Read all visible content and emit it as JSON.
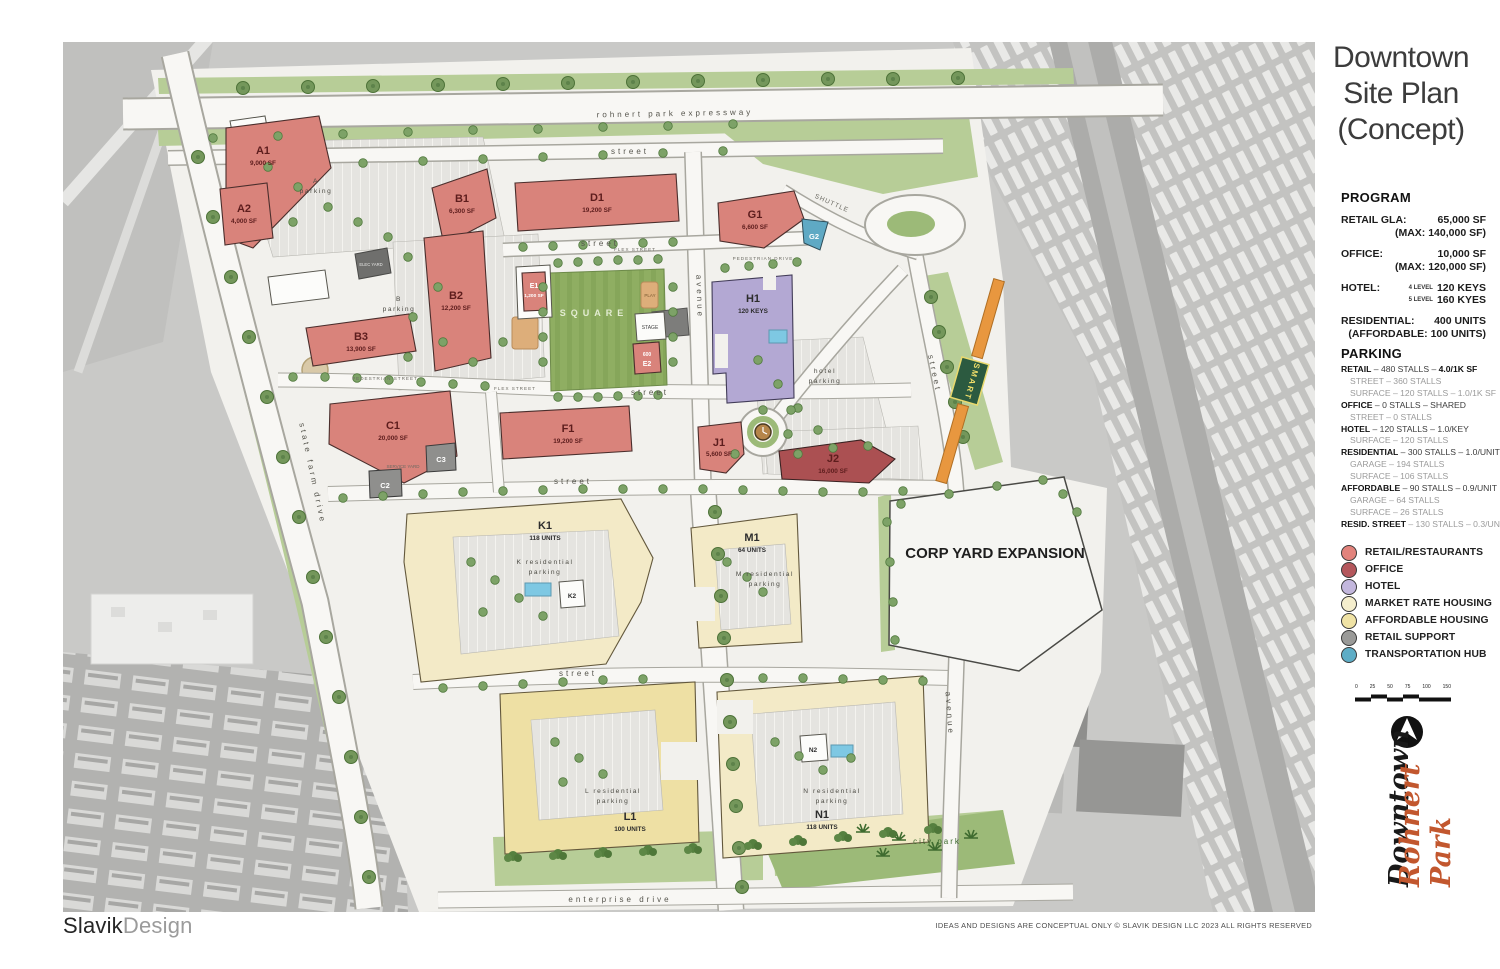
{
  "title": {
    "line1": "Downtown",
    "line2": "Site Plan",
    "line3": "(Concept)"
  },
  "program": {
    "heading": "PROGRAM",
    "retail": {
      "label": "RETAIL GLA:",
      "value": "65,000 SF",
      "sub": "(MAX: 140,000 SF)"
    },
    "office": {
      "label": "OFFICE:",
      "value": "10,000 SF",
      "sub": "(MAX: 120,000 SF)"
    },
    "hotel": {
      "label": "HOTEL:",
      "l1small": "4 LEVEL",
      "l1": "120 KEYS",
      "l2small": "5 LEVEL",
      "l2": "160 KYES"
    },
    "residential": {
      "label": "RESIDENTIAL:",
      "value": "400 UNITS",
      "sub": "(AFFORDABLE: 100 UNITS)"
    }
  },
  "parking": {
    "heading": "PARKING",
    "lines": [
      {
        "lead": "RETAIL",
        "rest": " – 480 STALLS – ",
        "tail": "4.0/1K SF"
      },
      {
        "lead": "",
        "rest": "STREET – 360 STALLS",
        "tail": ""
      },
      {
        "lead": "",
        "rest": "SURFACE – 120 STALLS – 1.0/1K SF",
        "tail": ""
      },
      {
        "lead": "OFFICE",
        "rest": " – 0 STALLS – SHARED",
        "tail": ""
      },
      {
        "lead": "",
        "rest": "STREET – 0 STALLS",
        "tail": ""
      },
      {
        "lead": "HOTEL",
        "rest": " – 120 STALLS – 1.0/KEY",
        "tail": ""
      },
      {
        "lead": "",
        "rest": "SURFACE – 120 STALLS",
        "tail": ""
      },
      {
        "lead": "RESIDENTIAL",
        "rest": " – 300 STALLS – 1.0/UNIT",
        "tail": ""
      },
      {
        "lead": "",
        "rest": "GARAGE – 194 STALLS",
        "tail": ""
      },
      {
        "lead": "",
        "rest": "SURFACE – 106 STALLS",
        "tail": ""
      },
      {
        "lead": "AFFORDABLE",
        "rest": " – 90 STALLS – 0.9/UNIT",
        "tail": ""
      },
      {
        "lead": "",
        "rest": "GARAGE – 64 STALLS",
        "tail": ""
      },
      {
        "lead": "",
        "rest": "SURFACE – 26 STALLS",
        "tail": ""
      },
      {
        "lead": "RESID. STREET",
        "rest": " – 130 STALLS –  0.3/UNIT",
        "tail": ""
      }
    ]
  },
  "legend": {
    "items": [
      {
        "label": "RETAIL/RESTAURANTS",
        "color": "#e2837c"
      },
      {
        "label": "OFFICE",
        "color": "#b4575c"
      },
      {
        "label": "HOTEL",
        "color": "#c3b7dd"
      },
      {
        "label": "MARKET RATE HOUSING",
        "color": "#f5eecd"
      },
      {
        "label": "AFFORDABLE HOUSING",
        "color": "#f0e3a5"
      },
      {
        "label": "RETAIL SUPPORT",
        "color": "#9a9a98"
      },
      {
        "label": "TRANSPORTATION HUB",
        "color": "#5eadc6"
      }
    ]
  },
  "scalebar": {
    "ticks": [
      "0",
      "25",
      "50",
      "75",
      "100",
      "150"
    ]
  },
  "branding": {
    "downtown": "Downtown",
    "rohnert_park": "Rohnert Park",
    "r_mark": "R",
    "city": "CITY OF ROHNERT PARK",
    "watermark1": "BAREIS®",
    "watermark2": "MLS"
  },
  "footer": {
    "studio_black": "Slavik",
    "studio_gray": "Design",
    "disclaimer": "IDEAS AND DESIGNS ARE CONCEPTUAL ONLY © SLAVIK DESIGN LLC  2023 ALL RIGHTS RESERVED"
  },
  "buildings": {
    "a1": {
      "name": "A1",
      "detail": "9,000 SF"
    },
    "a2": {
      "name": "A2",
      "detail": "4,000 SF"
    },
    "b1": {
      "name": "B1",
      "detail": "6,300 SF"
    },
    "b2": {
      "name": "B2",
      "detail": "12,200 SF"
    },
    "b3": {
      "name": "B3",
      "detail": "13,900 SF"
    },
    "c1": {
      "name": "C1",
      "detail": "20,000 SF"
    },
    "c2": {
      "name": "C2"
    },
    "c3": {
      "name": "C3"
    },
    "d1": {
      "name": "D1",
      "detail": "19,200 SF"
    },
    "e1": {
      "name": "E1",
      "detail": "1,200 SF"
    },
    "e2": {
      "name": "E2",
      "detail": "600"
    },
    "f1": {
      "name": "F1",
      "detail": "19,200 SF"
    },
    "g1": {
      "name": "G1",
      "detail": "6,600 SF"
    },
    "g2": {
      "name": "G2"
    },
    "h1": {
      "name": "H1",
      "detail": "120 KEYS"
    },
    "j1": {
      "name": "J1",
      "detail": "5,600 SF"
    },
    "j2": {
      "name": "J2",
      "detail": "16,000 SF"
    },
    "k1": {
      "name": "K1",
      "detail": "118 UNITS"
    },
    "k2": {
      "name": "K2"
    },
    "m1": {
      "name": "M1",
      "detail": "64 UNITS"
    },
    "l1": {
      "name": "L1",
      "detail": "100 UNITS"
    },
    "n1": {
      "name": "N1",
      "detail": "118 UNITS"
    },
    "n2": {
      "name": "N2"
    }
  },
  "labels": {
    "expressway": "rohnert park expressway",
    "street": "street",
    "avenue": "avenue",
    "state_farm": "state farm drive",
    "enterprise": "enterprise drive",
    "shuttle": "SHUTTLE",
    "smart": "SMART",
    "square": "SQUARE",
    "stage": "STAGE",
    "play": "PLAY",
    "flex": "FLEX STREET",
    "pedestrian_drive": "PEDESTRIAN DRIVE",
    "pedestrian_street": "PEDESTRIAN STREET",
    "a_block": "A",
    "b_block": "B",
    "parking_word": "parking",
    "hotel_word": "hotel",
    "k_res": "K residential",
    "m_res": "M residential",
    "l_res": "L residential",
    "n_res": "N residential",
    "service_yard": "SERVICE YARD",
    "elec_yard": "ELEC YARD",
    "corp_yard": "CORP YARD EXPANSION",
    "city_park": "city park"
  }
}
